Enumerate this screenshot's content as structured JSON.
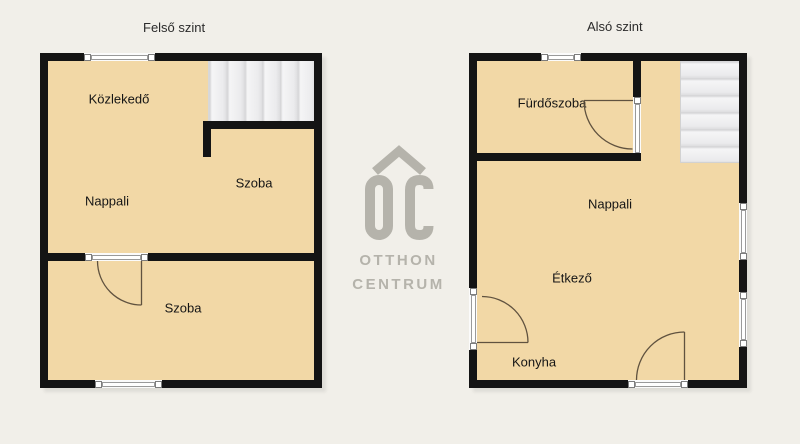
{
  "plans": {
    "upper": {
      "title": "Felső szint",
      "rooms": [
        {
          "name": "Közlekedő"
        },
        {
          "name": "Szoba"
        },
        {
          "name": "Nappali"
        },
        {
          "name": "Szoba"
        }
      ]
    },
    "lower": {
      "title": "Alsó szint",
      "rooms": [
        {
          "name": "Fürdőszoba"
        },
        {
          "name": "Nappali"
        },
        {
          "name": "Étkező"
        },
        {
          "name": "Konyha"
        }
      ]
    }
  },
  "logo": {
    "initials": "OC",
    "line1": "OTTHON",
    "line2": "CENTRUM",
    "icon": "roof-chevron-icon",
    "color": "#b5b3ab"
  },
  "colors": {
    "background": "#f1efe9",
    "floor": "#f2d8a6",
    "wall": "#141414",
    "stairs": "#ededee",
    "door_arc": "#60523f"
  }
}
